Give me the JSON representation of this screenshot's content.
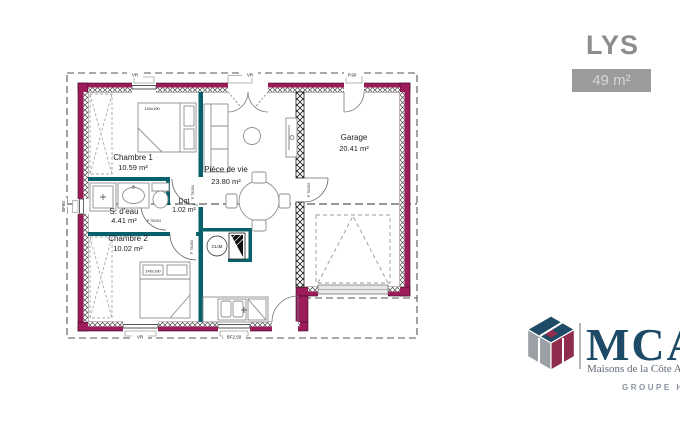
{
  "header": {
    "title": "LYS",
    "area_badge": "49 m²"
  },
  "rooms": [
    {
      "name": "Chambre 1",
      "area": "10.59 m²"
    },
    {
      "name": "S. d'eau",
      "area": "4.41 m²"
    },
    {
      "name": "Chambre 2",
      "area": "10.02 m²"
    },
    {
      "name": "Dgt",
      "area": "1.02 m²"
    },
    {
      "name": "Pièce de vie",
      "area": "23.80 m²"
    },
    {
      "name": "Garage",
      "area": "20.41 m²"
    }
  ],
  "labels": {
    "clim": "CLIM",
    "door": "P 75/204",
    "bed_size": "140x190",
    "vr": "VR",
    "left_window": "BF60",
    "kitchen_window": "BF2.50",
    "ped_door": "P.90"
  },
  "logo": {
    "name": "MCA",
    "tagline": "Maisons de la Côte Atlantique",
    "group": "GROUPE HEXAOM"
  },
  "colors": {
    "exterior_wall": "#9c1c59",
    "partition_wall": "#07606b",
    "logo_blue": "#1d4a66",
    "logo_maroon": "#8f2d4d",
    "logo_gray": "#9aa0a6",
    "title_gray": "#8d8d8d"
  }
}
